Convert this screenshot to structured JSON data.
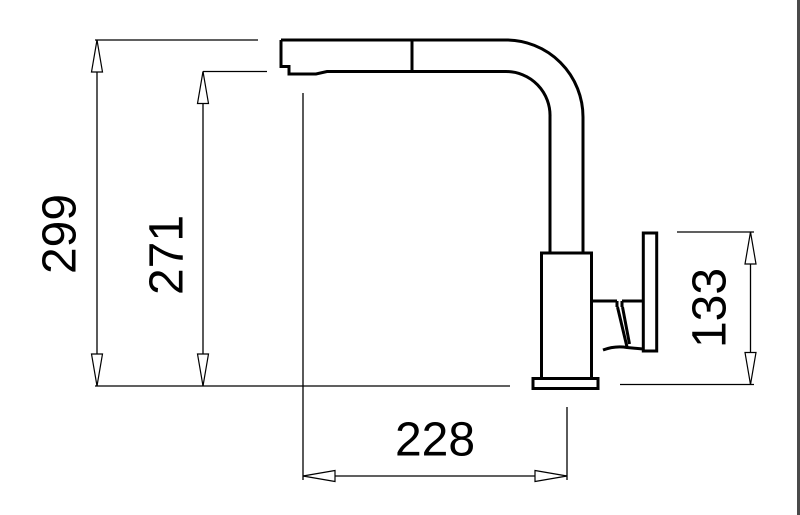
{
  "drawing": {
    "type": "technical-dimension-drawing",
    "subject": "kitchen mixer tap with pull-out spout, side elevation",
    "canvas": {
      "width": 800,
      "height": 515,
      "background_color": "#ffffff"
    },
    "colors": {
      "outline": "#000000",
      "dimension_lines": "#000000",
      "text": "#000000",
      "right_edge_border": "#4a4a4a"
    },
    "arrow_style": "open-triangle",
    "parts": [
      "spray-head",
      "aerator",
      "spout",
      "riser-pipe",
      "faucet-body",
      "base-flange",
      "cartridge-joint",
      "handle-lever",
      "counter-reference-line"
    ],
    "dimensions": [
      {
        "id": "dim-299",
        "label": "299",
        "value": 299,
        "orientation": "vertical",
        "measures": "overall height from counter to top of spout"
      },
      {
        "id": "dim-271",
        "label": "271",
        "value": 271,
        "orientation": "vertical",
        "measures": "clearance under spout outlet"
      },
      {
        "id": "dim-133",
        "label": "133",
        "value": 133,
        "orientation": "vertical",
        "measures": "handle height above counter"
      },
      {
        "id": "dim-228",
        "label": "228",
        "value": 228,
        "orientation": "horizontal",
        "measures": "spout reach from body axis to outlet"
      }
    ]
  }
}
